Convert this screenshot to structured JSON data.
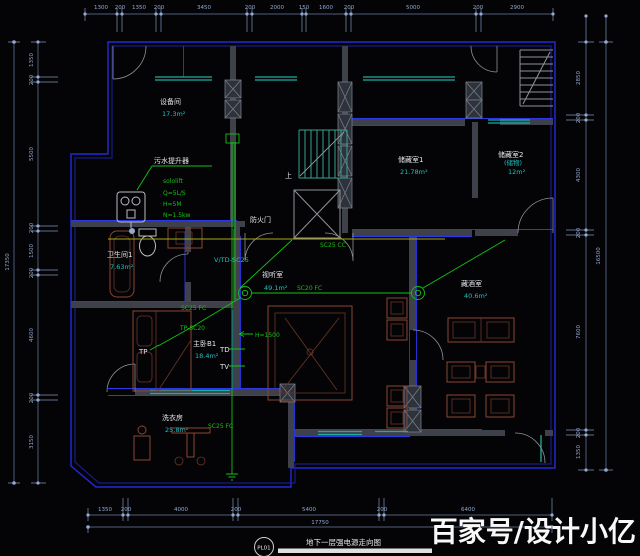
{
  "watermark": "百家号/设计小亿",
  "title_block": {
    "code": "PL01",
    "title": "地下一层强电源走向图"
  },
  "colors": {
    "wall_blue": "#2329d6",
    "wiring_green": "#14c214",
    "dimension_blue": "#93a9d0",
    "window_teal": "#1fae9e",
    "furniture_brown": "#8a4532",
    "highlight_yellow": "#a8a818"
  },
  "rooms": {
    "equipment": {
      "name": "设备间",
      "area": "17.3m²"
    },
    "storage1": {
      "name": "储藏室1",
      "area": "21.78m²"
    },
    "storage2": {
      "name": "储藏室2",
      "sub": "(储物)",
      "area": "12m²"
    },
    "bath": {
      "name": "卫生间1",
      "area": "7.63m²"
    },
    "av": {
      "name": "视听室",
      "area": "49.1m²"
    },
    "bedroom": {
      "name": "主卧B1",
      "area": "18.4m²"
    },
    "laundry": {
      "name": "洗衣房",
      "area": "25.8m²"
    },
    "wine": {
      "name": "藏酒室",
      "area": "40.6m²"
    }
  },
  "labels": {
    "pump_title": "污水提升器",
    "pump_specs": [
      "sololift",
      "Q=5L/S",
      "H=5M",
      "N=1.5kw"
    ],
    "fire_door": "防火门",
    "up": "上",
    "wire_cc": "SC25 CC",
    "wire_av": "SC20 FC",
    "wire_bed": "SC25 FC",
    "wire_laundry": "SC25 FC",
    "wire_tp": "TP-SC20",
    "wire_vtd": "V/TD-SC25",
    "wire_h": "H=1500",
    "tp": "TP",
    "td": "TD",
    "tv": "TV"
  },
  "dimensions": {
    "top": [
      "1300",
      "200",
      "1350",
      "200",
      "3450",
      "200",
      "2000",
      "150",
      "1600",
      "200",
      "5000",
      "200",
      "2900"
    ],
    "bottom": [
      "1350",
      "200",
      "4000",
      "200",
      "5400",
      "200",
      "6400"
    ],
    "bottom_total": "17750",
    "left": [
      "1350",
      "200",
      "5500",
      "200",
      "1500",
      "200",
      "4600",
      "200",
      "3150"
    ],
    "left_total": "17350",
    "right": [
      "2850",
      "200",
      "4300",
      "200",
      "7600",
      "200",
      "1350"
    ],
    "right_total": "16500"
  }
}
